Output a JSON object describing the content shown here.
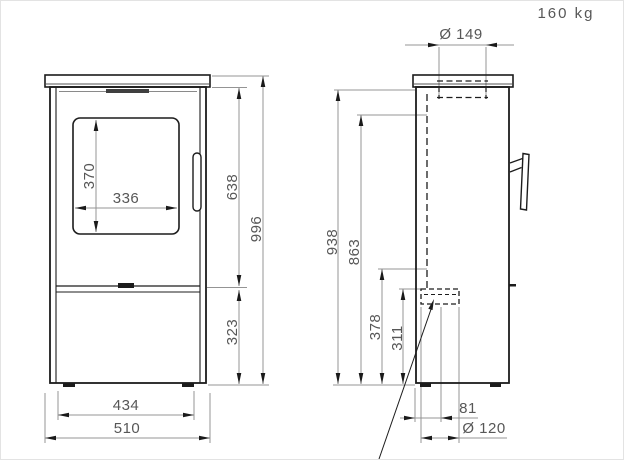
{
  "drawing": {
    "weight_label": "160 kg",
    "flue_top": {
      "diameter": "Ø 149"
    },
    "front_view": {
      "glass_height": "370",
      "glass_width": "336",
      "firebox_top_height": "638",
      "total_height": "996",
      "base_height": "323",
      "body_width": "434",
      "overall_width": "510"
    },
    "side_view": {
      "rear_top_height": "938",
      "rear_flue_center_height": "863",
      "air_inlet_top_height": "378",
      "air_inlet_center_height": "311",
      "air_inlet_rear_offset": "81",
      "air_inlet_diameter": "Ø 120"
    },
    "colors": {
      "outline": "#1c1c1c",
      "dimension_line": "#949494",
      "dimension_text": "#575757",
      "arrow": "#1a1a1a"
    }
  }
}
